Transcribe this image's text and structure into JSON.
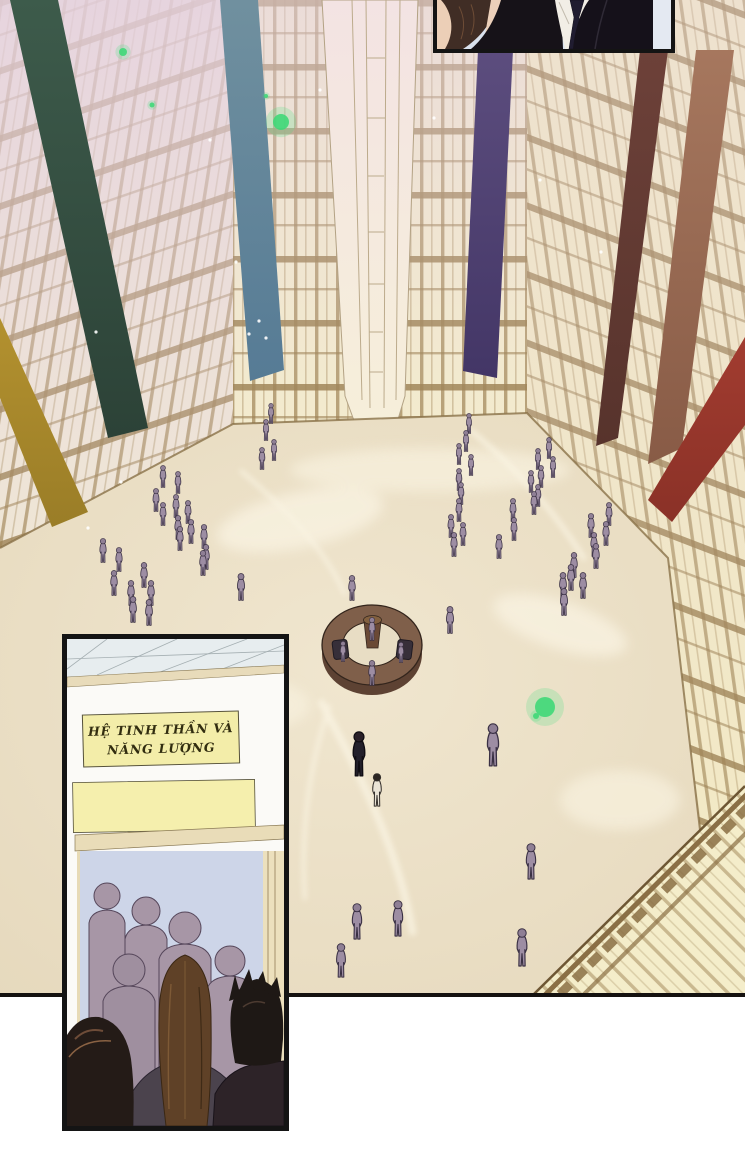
{
  "sign": {
    "line1": "HỆ TINH THẦN VÀ",
    "line2": "NĂNG LƯỢNG"
  },
  "palette": {
    "wall_cream": "#f2e9c8",
    "wall_pink": "#e5d1e0",
    "wall_beam": "#a68c5e",
    "floor_marble": "#ebdfc5",
    "ring_brown": "#7f5f4a",
    "figure_mauve": "#9d8da3",
    "glow_green": "#3fd878",
    "panel_border": "#141414",
    "sign_yellow": "#f3eda9",
    "door_blue": "#cdd5e8"
  },
  "scene": {
    "banners": [
      {
        "name": "green",
        "points": "10,0 58,0 148,428 108,438",
        "from": "#3d5b4b",
        "to": "#2c4237"
      },
      {
        "name": "gold",
        "points": "0,318 88,512 52,527 0,398",
        "from": "#b3912f",
        "to": "#9a7d27"
      },
      {
        "name": "steel-blue",
        "points": "220,0 258,0 284,370 250,381",
        "from": "#70909f",
        "to": "#567b95"
      },
      {
        "name": "purple",
        "points": "478,50 513,50 497,378 463,371",
        "from": "#5c4d7e",
        "to": "#433666"
      },
      {
        "name": "maroon",
        "points": "640,50 668,50 618,438 596,446",
        "from": "#6d4139",
        "to": "#57332c"
      },
      {
        "name": "brown",
        "points": "696,50 734,50 682,448 648,464",
        "from": "#a6775e",
        "to": "#885b46"
      },
      {
        "name": "red",
        "points": "745,337 745,425 672,522 648,500",
        "from": "#a23c30",
        "to": "#8a3127"
      }
    ],
    "figure_variants": {
      "0": {
        "head": "#8f7f95",
        "body": "#9d8da3",
        "stroke": "#3a3044"
      },
      "1": {
        "head": "#2a2029",
        "body": "#23202b",
        "stroke": "#100d13"
      },
      "2": {
        "head": "#2c2623",
        "body": "#eae4d6",
        "stroke": "#35302c"
      }
    },
    "figures": [
      [
        271,
        424,
        21,
        0
      ],
      [
        266,
        441,
        22,
        0
      ],
      [
        274,
        461,
        22,
        0
      ],
      [
        262,
        470,
        23,
        0
      ],
      [
        163,
        488,
        23,
        0
      ],
      [
        178,
        494,
        23,
        0
      ],
      [
        156,
        512,
        24,
        0
      ],
      [
        176,
        518,
        24,
        0
      ],
      [
        188,
        524,
        24,
        0
      ],
      [
        163,
        526,
        24,
        0
      ],
      [
        178,
        540,
        25,
        0
      ],
      [
        191,
        544,
        25,
        0
      ],
      [
        204,
        549,
        25,
        0
      ],
      [
        180,
        551,
        25,
        0
      ],
      [
        206,
        570,
        26,
        0
      ],
      [
        203,
        576,
        26,
        0
      ],
      [
        103,
        563,
        25,
        0
      ],
      [
        119,
        572,
        25,
        0
      ],
      [
        144,
        588,
        26,
        0
      ],
      [
        114,
        596,
        26,
        0
      ],
      [
        131,
        606,
        26,
        0
      ],
      [
        151,
        606,
        26,
        0
      ],
      [
        133,
        623,
        27,
        0
      ],
      [
        149,
        626,
        27,
        0
      ],
      [
        469,
        434,
        21,
        0
      ],
      [
        466,
        452,
        22,
        0
      ],
      [
        459,
        465,
        22,
        0
      ],
      [
        471,
        476,
        22,
        0
      ],
      [
        459,
        491,
        23,
        0
      ],
      [
        461,
        505,
        23,
        0
      ],
      [
        459,
        522,
        24,
        0
      ],
      [
        451,
        538,
        24,
        0
      ],
      [
        463,
        546,
        24,
        0
      ],
      [
        454,
        557,
        25,
        0
      ],
      [
        549,
        459,
        22,
        0
      ],
      [
        538,
        470,
        22,
        0
      ],
      [
        553,
        478,
        22,
        0
      ],
      [
        541,
        488,
        23,
        0
      ],
      [
        531,
        493,
        23,
        0
      ],
      [
        538,
        507,
        23,
        0
      ],
      [
        534,
        515,
        24,
        0
      ],
      [
        513,
        522,
        24,
        0
      ],
      [
        514,
        541,
        24,
        0
      ],
      [
        499,
        559,
        25,
        0
      ],
      [
        609,
        526,
        24,
        0
      ],
      [
        591,
        538,
        25,
        0
      ],
      [
        606,
        546,
        25,
        0
      ],
      [
        594,
        557,
        25,
        0
      ],
      [
        596,
        569,
        26,
        0
      ],
      [
        574,
        578,
        26,
        0
      ],
      [
        571,
        591,
        27,
        0
      ],
      [
        563,
        599,
        27,
        0
      ],
      [
        583,
        599,
        27,
        0
      ],
      [
        564,
        616,
        28,
        0
      ],
      [
        450,
        634,
        28,
        0
      ],
      [
        241,
        601,
        28,
        0
      ],
      [
        352,
        601,
        26,
        0
      ],
      [
        372,
        641,
        24,
        0
      ],
      [
        343,
        662,
        21,
        0
      ],
      [
        401,
        663,
        21,
        0
      ],
      [
        372,
        686,
        26,
        0
      ],
      [
        493,
        767,
        44,
        0
      ],
      [
        359,
        777,
        46,
        1
      ],
      [
        377,
        807,
        34,
        2
      ],
      [
        531,
        880,
        37,
        0
      ],
      [
        522,
        967,
        39,
        0
      ],
      [
        357,
        940,
        37,
        0
      ],
      [
        398,
        937,
        37,
        0
      ],
      [
        341,
        978,
        35,
        0
      ]
    ],
    "particles": [
      [
        123,
        52,
        4
      ],
      [
        152,
        105,
        2.5
      ],
      [
        266,
        96,
        2
      ],
      [
        281,
        122,
        8
      ],
      [
        545,
        707,
        10
      ],
      [
        536,
        716,
        3
      ]
    ],
    "specks": [
      [
        210,
        140
      ],
      [
        236,
        262
      ],
      [
        96,
        332
      ],
      [
        259,
        321
      ],
      [
        249,
        334
      ],
      [
        266,
        338
      ],
      [
        601,
        252
      ],
      [
        434,
        118
      ],
      [
        121,
        482
      ],
      [
        88,
        528
      ],
      [
        540,
        180
      ],
      [
        320,
        90
      ]
    ]
  }
}
